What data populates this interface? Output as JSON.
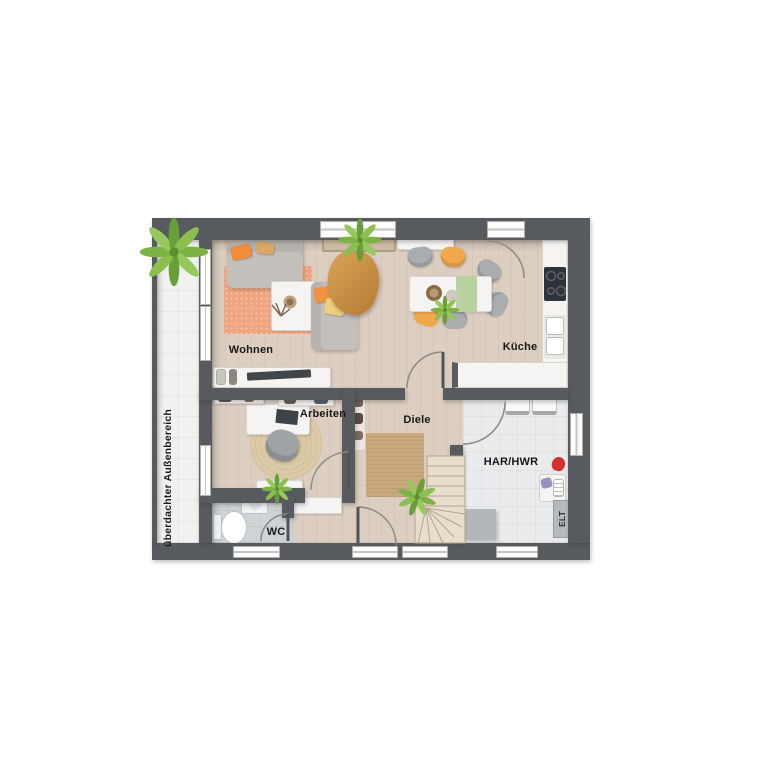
{
  "floorplan": {
    "rooms": {
      "wohnen": "Wohnen",
      "kueche": "Küche",
      "arbeiten": "Arbeiten",
      "diele": "Diele",
      "har_hwr": "HAR/HWR",
      "wc": "WC"
    },
    "annotations": {
      "elt": "ELT",
      "outdoor_area": "überdachter Außenbereich"
    },
    "colors": {
      "wall": "#575b5f",
      "wood_floor": "#dccec1",
      "outdoor_tile": "#f1f1ef",
      "har_tile": "#e9ebed",
      "wc_tile": "#cfd4d7",
      "living_rug": "#efa57f",
      "jute_rug": "#c9a87d",
      "accent_orange": "#f09440",
      "accent_yellow": "#ecd07e",
      "accent_green": "#8cbf4e",
      "sofa_gray": "#c3bfbb",
      "furniture_white": "#f5f4f2",
      "cooktop_black": "#2e3337",
      "red_item": "#d0312e"
    }
  }
}
